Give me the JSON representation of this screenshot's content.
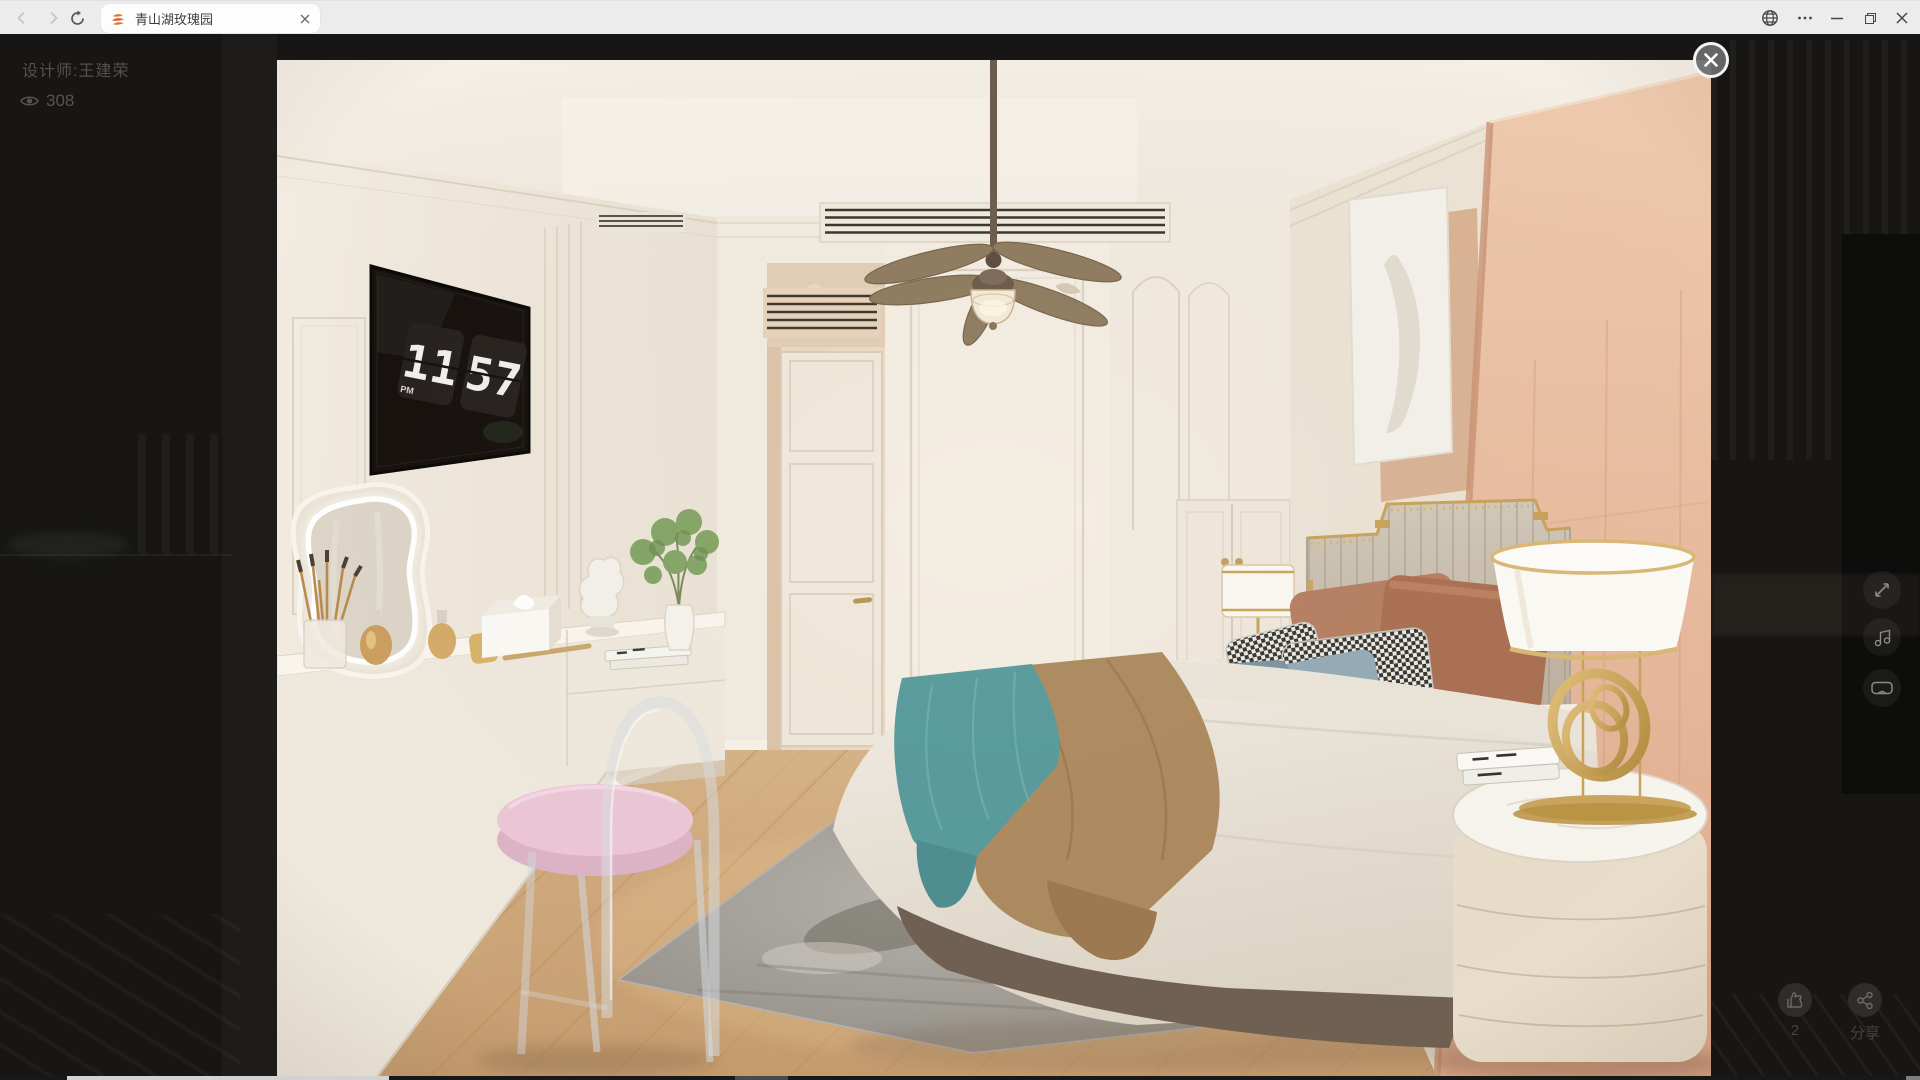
{
  "browser": {
    "tab_title": "青山湖玫瑰园"
  },
  "page": {
    "designer_label": "设计师:王建荣",
    "view_count": "308",
    "like_count": "2",
    "share_label": "分享"
  },
  "photo": {
    "clock": {
      "hours": "11",
      "minutes": "57",
      "meridiem": "PM"
    }
  },
  "icons": {
    "back": "chevron-left",
    "forward": "chevron-right",
    "refresh": "circular-arrow",
    "favicon": "orange-layers",
    "tab_close": "x",
    "globe": "globe",
    "more": "ellipsis",
    "minimize": "line",
    "restore": "overlap-squares",
    "window_close": "x",
    "lightbox_close": "x-circle",
    "views": "eye",
    "like": "thumbs-up",
    "share": "share-nodes",
    "fullscreen": "expand-arrows",
    "music": "music-note",
    "vr": "vr-goggles"
  },
  "colors": {
    "toolbar_bg": "#ececec",
    "tab_bg": "#fdfdfd",
    "page_dim": "#171615",
    "accent_peach": "#e7bb9f",
    "teal_throw": "#579a9c",
    "camel_blanket": "#ad8a5f",
    "favicon_orange": "#e2702f",
    "scrollbar_thumb": "#d2d2d2",
    "cushion_pink": "#ecc6d6"
  }
}
